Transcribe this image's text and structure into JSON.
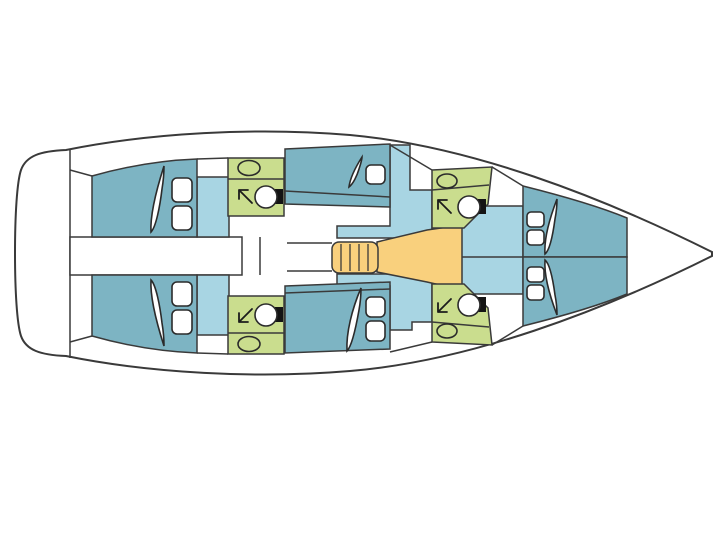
{
  "diagram": {
    "type": "yacht-interior-floor-plan",
    "orientation": "bow-right-stern-left",
    "view": "top-down deck layout, no text labels"
  },
  "colors": {
    "background": "#ffffff",
    "hull_fill": "#ffffff",
    "outline": "#3a3a3a",
    "cabin": "#7db4c3",
    "walkway": "#a8d5e3",
    "head": "#cadd8e",
    "salon": "#f9d07d",
    "fixture": "#ffffff",
    "tank": "#141414"
  },
  "legend": {
    "cabin_color_meaning": "sleeping cabins",
    "walkway_color_meaning": "passage / wardrobe areas",
    "head_color_meaning": "bathrooms with shower",
    "salon_color_meaning": "salon and companionway stairs"
  },
  "rooms": [
    {
      "id": "stern-platform"
    },
    {
      "id": "aft-cabin-port",
      "berth_pillows": 2
    },
    {
      "id": "aft-cabin-starboard",
      "berth_pillows": 2
    },
    {
      "id": "aft-corridor-engine"
    },
    {
      "id": "head-port-aft",
      "fixtures": [
        "sink",
        "shower-arrow",
        "toilet"
      ]
    },
    {
      "id": "head-starboard-aft",
      "fixtures": [
        "sink",
        "shower-arrow",
        "toilet"
      ]
    },
    {
      "id": "mid-cabin-port",
      "berth_pillows": 1
    },
    {
      "id": "mid-cabin-starboard",
      "berth_pillows": 2
    },
    {
      "id": "companionway-stairs",
      "steps": 4
    },
    {
      "id": "salon-galley"
    },
    {
      "id": "head-port-forward",
      "fixtures": [
        "sink",
        "shower-arrow",
        "toilet"
      ]
    },
    {
      "id": "head-starboard-forward",
      "fixtures": [
        "sink",
        "shower-arrow",
        "toilet"
      ]
    },
    {
      "id": "forward-cabin-port",
      "berth_pillows": 2
    },
    {
      "id": "forward-cabin-starboard",
      "berth_pillows": 2
    },
    {
      "id": "bow-locker"
    }
  ],
  "fixture_totals": {
    "toilets": 4,
    "sinks": 4,
    "showers": 4,
    "cabins": 6,
    "berth_blades": 6
  }
}
